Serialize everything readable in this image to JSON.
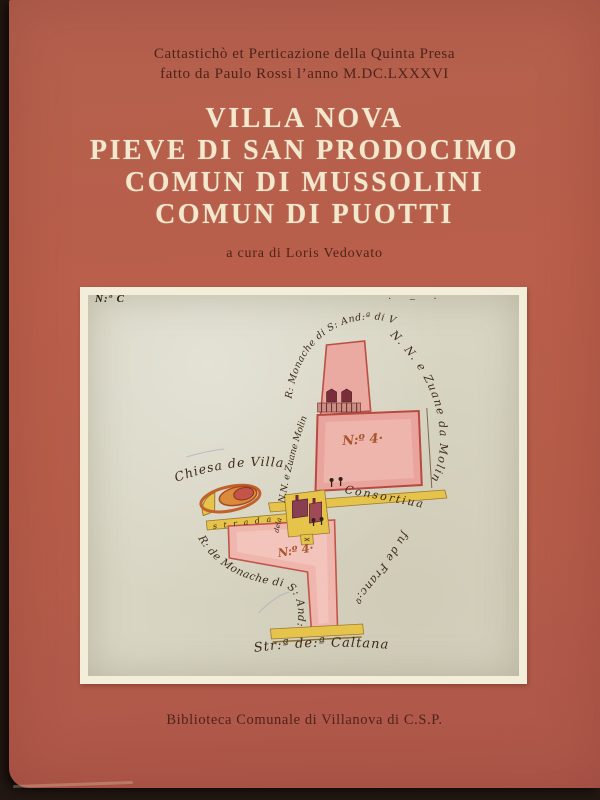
{
  "cover": {
    "header_line1": "Cattastichò et Perticazione della Quinta Presa",
    "header_line2": "fatto da Paulo Rossi l’anno M.DC.LXXXVI",
    "title_lines": [
      "VILLA NOVA",
      "PIEVE DI SAN PRODOCIMO",
      "COMUN DI MUSSOLINI",
      "COMUN DI PUOTTI"
    ],
    "editor_line": "a cura di Loris Vedovato",
    "footer_line": "Biblioteca Comunale di Villanova di C.S.P.",
    "colors": {
      "cover_terracotta": "#b75f4b",
      "title_cream": "#f2e8cd",
      "text_dark_maroon": "#4e2318",
      "mat_white": "#f3eeda",
      "paper_aged": "#d8d5c3",
      "parcel_pink": "#e9aba3",
      "road_yellow": "#e6c34a",
      "ink_brown": "#3d2a18"
    }
  },
  "map": {
    "corner_note": "N:º C",
    "corner_marks": "· – ·",
    "parcel_upper_label": "N:º 4·",
    "parcel_lower_label": "N:º 4·",
    "labels": {
      "monache_top": "R: Monache di S: And:ª di V:ª",
      "zuane_left": "N.N. e Zuane Molin",
      "zuane_right": "N. N. e Zuane da Molin",
      "fu_de_franco": "fu de Franc:º",
      "consortiva": "Consortiua",
      "chiesa": "Chiesa de Villa Noua",
      "strada": "s t r a d a",
      "dela": "dela",
      "monache_lower": "R: de Monache di S: And:ª",
      "caltana": "Str:ª de:ª Caltana"
    }
  }
}
